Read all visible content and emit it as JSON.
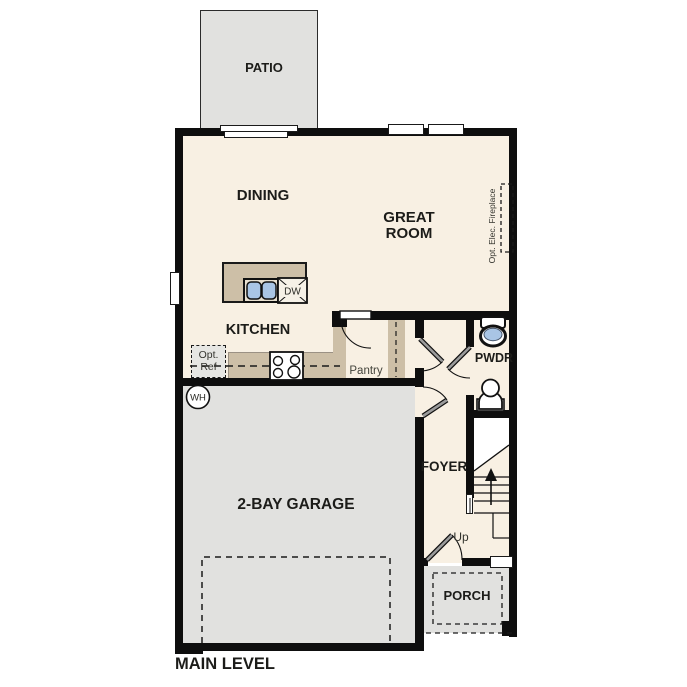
{
  "plan": {
    "title": "MAIN LEVEL",
    "labels": {
      "patio": "PATIO",
      "dining": "DINING",
      "great_room": "GREAT ROOM",
      "kitchen": "KITCHEN",
      "pantry": "Pantry",
      "pwdr": "PWDR",
      "foyer": "FOYER",
      "garage": "2-BAY GARAGE",
      "porch": "PORCH",
      "up": "Up",
      "dw": "DW",
      "wh": "WH",
      "opt_ref": "Opt. Ref",
      "fireplace": "Opt. Elec. Fireplace"
    },
    "colors": {
      "floor": "#f8f0e3",
      "casework_tan": "#cdbfa7",
      "concrete_gray": "#e1e1df",
      "fixture_blue": "#a9c5e5",
      "wall_black": "#0e0e0e"
    }
  }
}
